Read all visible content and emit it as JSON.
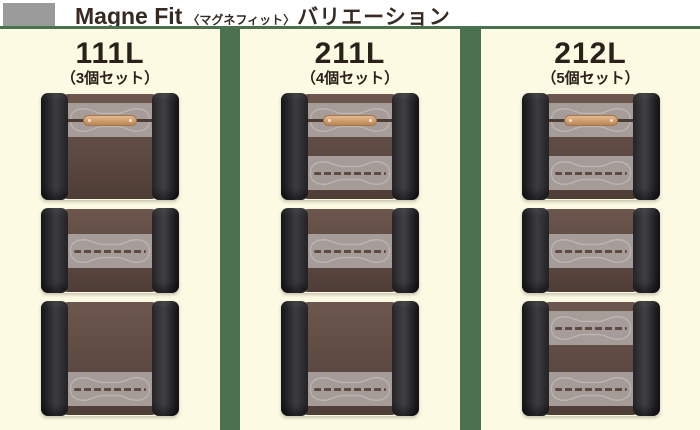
{
  "header": {
    "title_en": "Magne Fit",
    "title_bracket": "〈マグネフィット〉",
    "title_ja": "バリエーション"
  },
  "variations": [
    {
      "model": "111L",
      "set_label": "（3個セット）",
      "cases": [
        {
          "height": 107,
          "bands": [
            {
              "position": "top",
              "type": "tag"
            }
          ]
        },
        {
          "height": 85,
          "bands": [
            {
              "position": "middle",
              "type": "slot"
            }
          ]
        },
        {
          "height": 115,
          "bands": [
            {
              "position": "bottom",
              "type": "slot"
            }
          ]
        }
      ]
    },
    {
      "model": "211L",
      "set_label": "（4個セット）",
      "cases": [
        {
          "height": 107,
          "bands": [
            {
              "position": "top",
              "type": "tag"
            },
            {
              "position": "bottom",
              "type": "slot"
            }
          ]
        },
        {
          "height": 85,
          "bands": [
            {
              "position": "middle",
              "type": "slot"
            }
          ]
        },
        {
          "height": 115,
          "bands": [
            {
              "position": "bottom",
              "type": "slot"
            }
          ]
        }
      ]
    },
    {
      "model": "212L",
      "set_label": "（5個セット）",
      "cases": [
        {
          "height": 107,
          "bands": [
            {
              "position": "top",
              "type": "tag"
            },
            {
              "position": "bottom",
              "type": "slot"
            }
          ]
        },
        {
          "height": 85,
          "bands": [
            {
              "position": "middle",
              "type": "slot"
            }
          ]
        },
        {
          "height": 115,
          "bands": [
            {
              "position": "top",
              "type": "slot"
            },
            {
              "position": "bottom",
              "type": "slot"
            }
          ]
        }
      ]
    }
  ],
  "colors": {
    "background_green": "#4a7150",
    "panel_cream": "#fdfae3",
    "header_bullet_gray": "#9b9b9b",
    "title_text": "#362a22",
    "model_text": "#2a211b",
    "case_body_brown_light": "#6c564d",
    "band_gray": "#aaa19e",
    "stitch_gray": "#c9c1be",
    "tag_tan": "#d5a06f"
  }
}
